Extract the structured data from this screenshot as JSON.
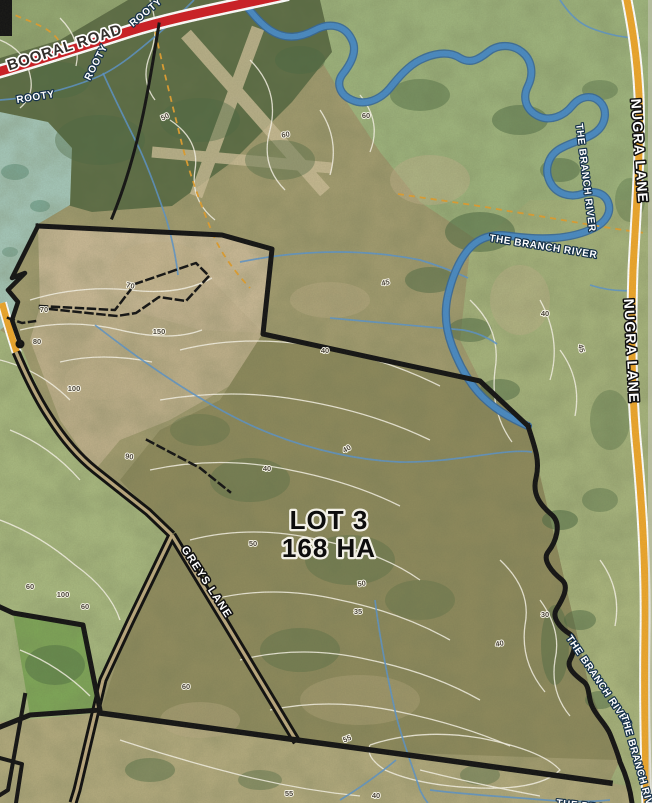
{
  "map": {
    "lot": {
      "name": "LOT 3",
      "area": "168 HA"
    },
    "roads": {
      "booral": "BOORAL ROAD",
      "greys": "GREYS LANE",
      "nugra": "NUGRA LANE"
    },
    "water": {
      "branch_river": "THE BRANCH RIVER",
      "rooty": "ROOTY"
    },
    "colors": {
      "booral_road": "#ce1f26",
      "nugra_lane": "#eca62d",
      "river": "#4a8ac2",
      "boundary": "#151515",
      "contour": "#f7f3e6",
      "track": "#dd9e33"
    },
    "placed_labels": [
      {
        "text": "ROOTY",
        "x": 133,
        "y": 27,
        "rot": -40,
        "cls": "lbl-water",
        "name": "creek-label-rooty"
      },
      {
        "text": "ROOTY",
        "x": 90,
        "y": 81,
        "rot": -63,
        "cls": "lbl-water",
        "name": "creek-label-rooty"
      },
      {
        "text": "ROOTY",
        "x": 17,
        "y": 103,
        "rot": -9,
        "cls": "lbl-water",
        "name": "creek-label-rooty"
      },
      {
        "text": "THE BRANCH RIVER",
        "x": 489,
        "y": 241,
        "rot": 9,
        "cls": "lbl-water",
        "name": "river-label-branch"
      },
      {
        "text": "THE BRANCH RIVER",
        "x": 576,
        "y": 124,
        "rot": 83,
        "cls": "lbl-water",
        "name": "river-label-branch"
      },
      {
        "text": "THE BRANCH RIVER",
        "x": 566,
        "y": 638,
        "rot": 56,
        "cls": "lbl-water",
        "name": "river-label-branch"
      },
      {
        "text": "THE BRANCH RIVER",
        "x": 621,
        "y": 716,
        "rot": 74,
        "cls": "lbl-water",
        "name": "river-label-branch"
      },
      {
        "text": "THE BRANCH RIVER",
        "x": 556,
        "y": 806,
        "rot": 6,
        "cls": "lbl-water",
        "name": "river-label-branch"
      },
      {
        "text": "NUGRA LANE",
        "x": 631,
        "y": 99,
        "rot": 86,
        "cls": "lbl-roadlight",
        "name": "road-label-nugra-lane"
      },
      {
        "text": "NUGRA LANE",
        "x": 624,
        "y": 299,
        "rot": 87,
        "cls": "lbl-roadlight",
        "name": "road-label-nugra-lane"
      }
    ],
    "contour_labels": [
      {
        "t": "50",
        "x": 166,
        "y": 119,
        "r": -25
      },
      {
        "t": "60",
        "x": 286,
        "y": 137,
        "r": -10
      },
      {
        "t": "60",
        "x": 366,
        "y": 118,
        "r": 0
      },
      {
        "t": "70",
        "x": 44,
        "y": 312,
        "r": 0
      },
      {
        "t": "80",
        "x": 37,
        "y": 344,
        "r": 0
      },
      {
        "t": "70",
        "x": 130,
        "y": 288,
        "r": 12
      },
      {
        "t": "150",
        "x": 159,
        "y": 334,
        "r": 0
      },
      {
        "t": "100",
        "x": 74,
        "y": 391,
        "r": 0
      },
      {
        "t": "90",
        "x": 129,
        "y": 459,
        "r": 8
      },
      {
        "t": "100",
        "x": 63,
        "y": 597,
        "r": 0
      },
      {
        "t": "60",
        "x": 30,
        "y": 589,
        "r": 0
      },
      {
        "t": "45",
        "x": 386,
        "y": 285,
        "r": -12
      },
      {
        "t": "40",
        "x": 325,
        "y": 353,
        "r": 0
      },
      {
        "t": "40",
        "x": 348,
        "y": 451,
        "r": -30
      },
      {
        "t": "40",
        "x": 267,
        "y": 471,
        "r": 0
      },
      {
        "t": "40",
        "x": 364,
        "y": 520,
        "r": -20
      },
      {
        "t": "50",
        "x": 253,
        "y": 546,
        "r": 0
      },
      {
        "t": "50",
        "x": 362,
        "y": 586,
        "r": -8
      },
      {
        "t": "60",
        "x": 85,
        "y": 609,
        "r": 0
      },
      {
        "t": "60",
        "x": 186,
        "y": 689,
        "r": 0
      },
      {
        "t": "55",
        "x": 348,
        "y": 741,
        "r": -22
      },
      {
        "t": "55",
        "x": 289,
        "y": 796,
        "r": 0
      },
      {
        "t": "40",
        "x": 376,
        "y": 798,
        "r": 0
      },
      {
        "t": "35",
        "x": 358,
        "y": 614,
        "r": 0
      },
      {
        "t": "40",
        "x": 500,
        "y": 646,
        "r": -10
      },
      {
        "t": "30",
        "x": 545,
        "y": 617,
        "r": 0
      },
      {
        "t": "40",
        "x": 545,
        "y": 316,
        "r": 0
      },
      {
        "t": "45",
        "x": 579,
        "y": 349,
        "r": 75
      }
    ]
  }
}
